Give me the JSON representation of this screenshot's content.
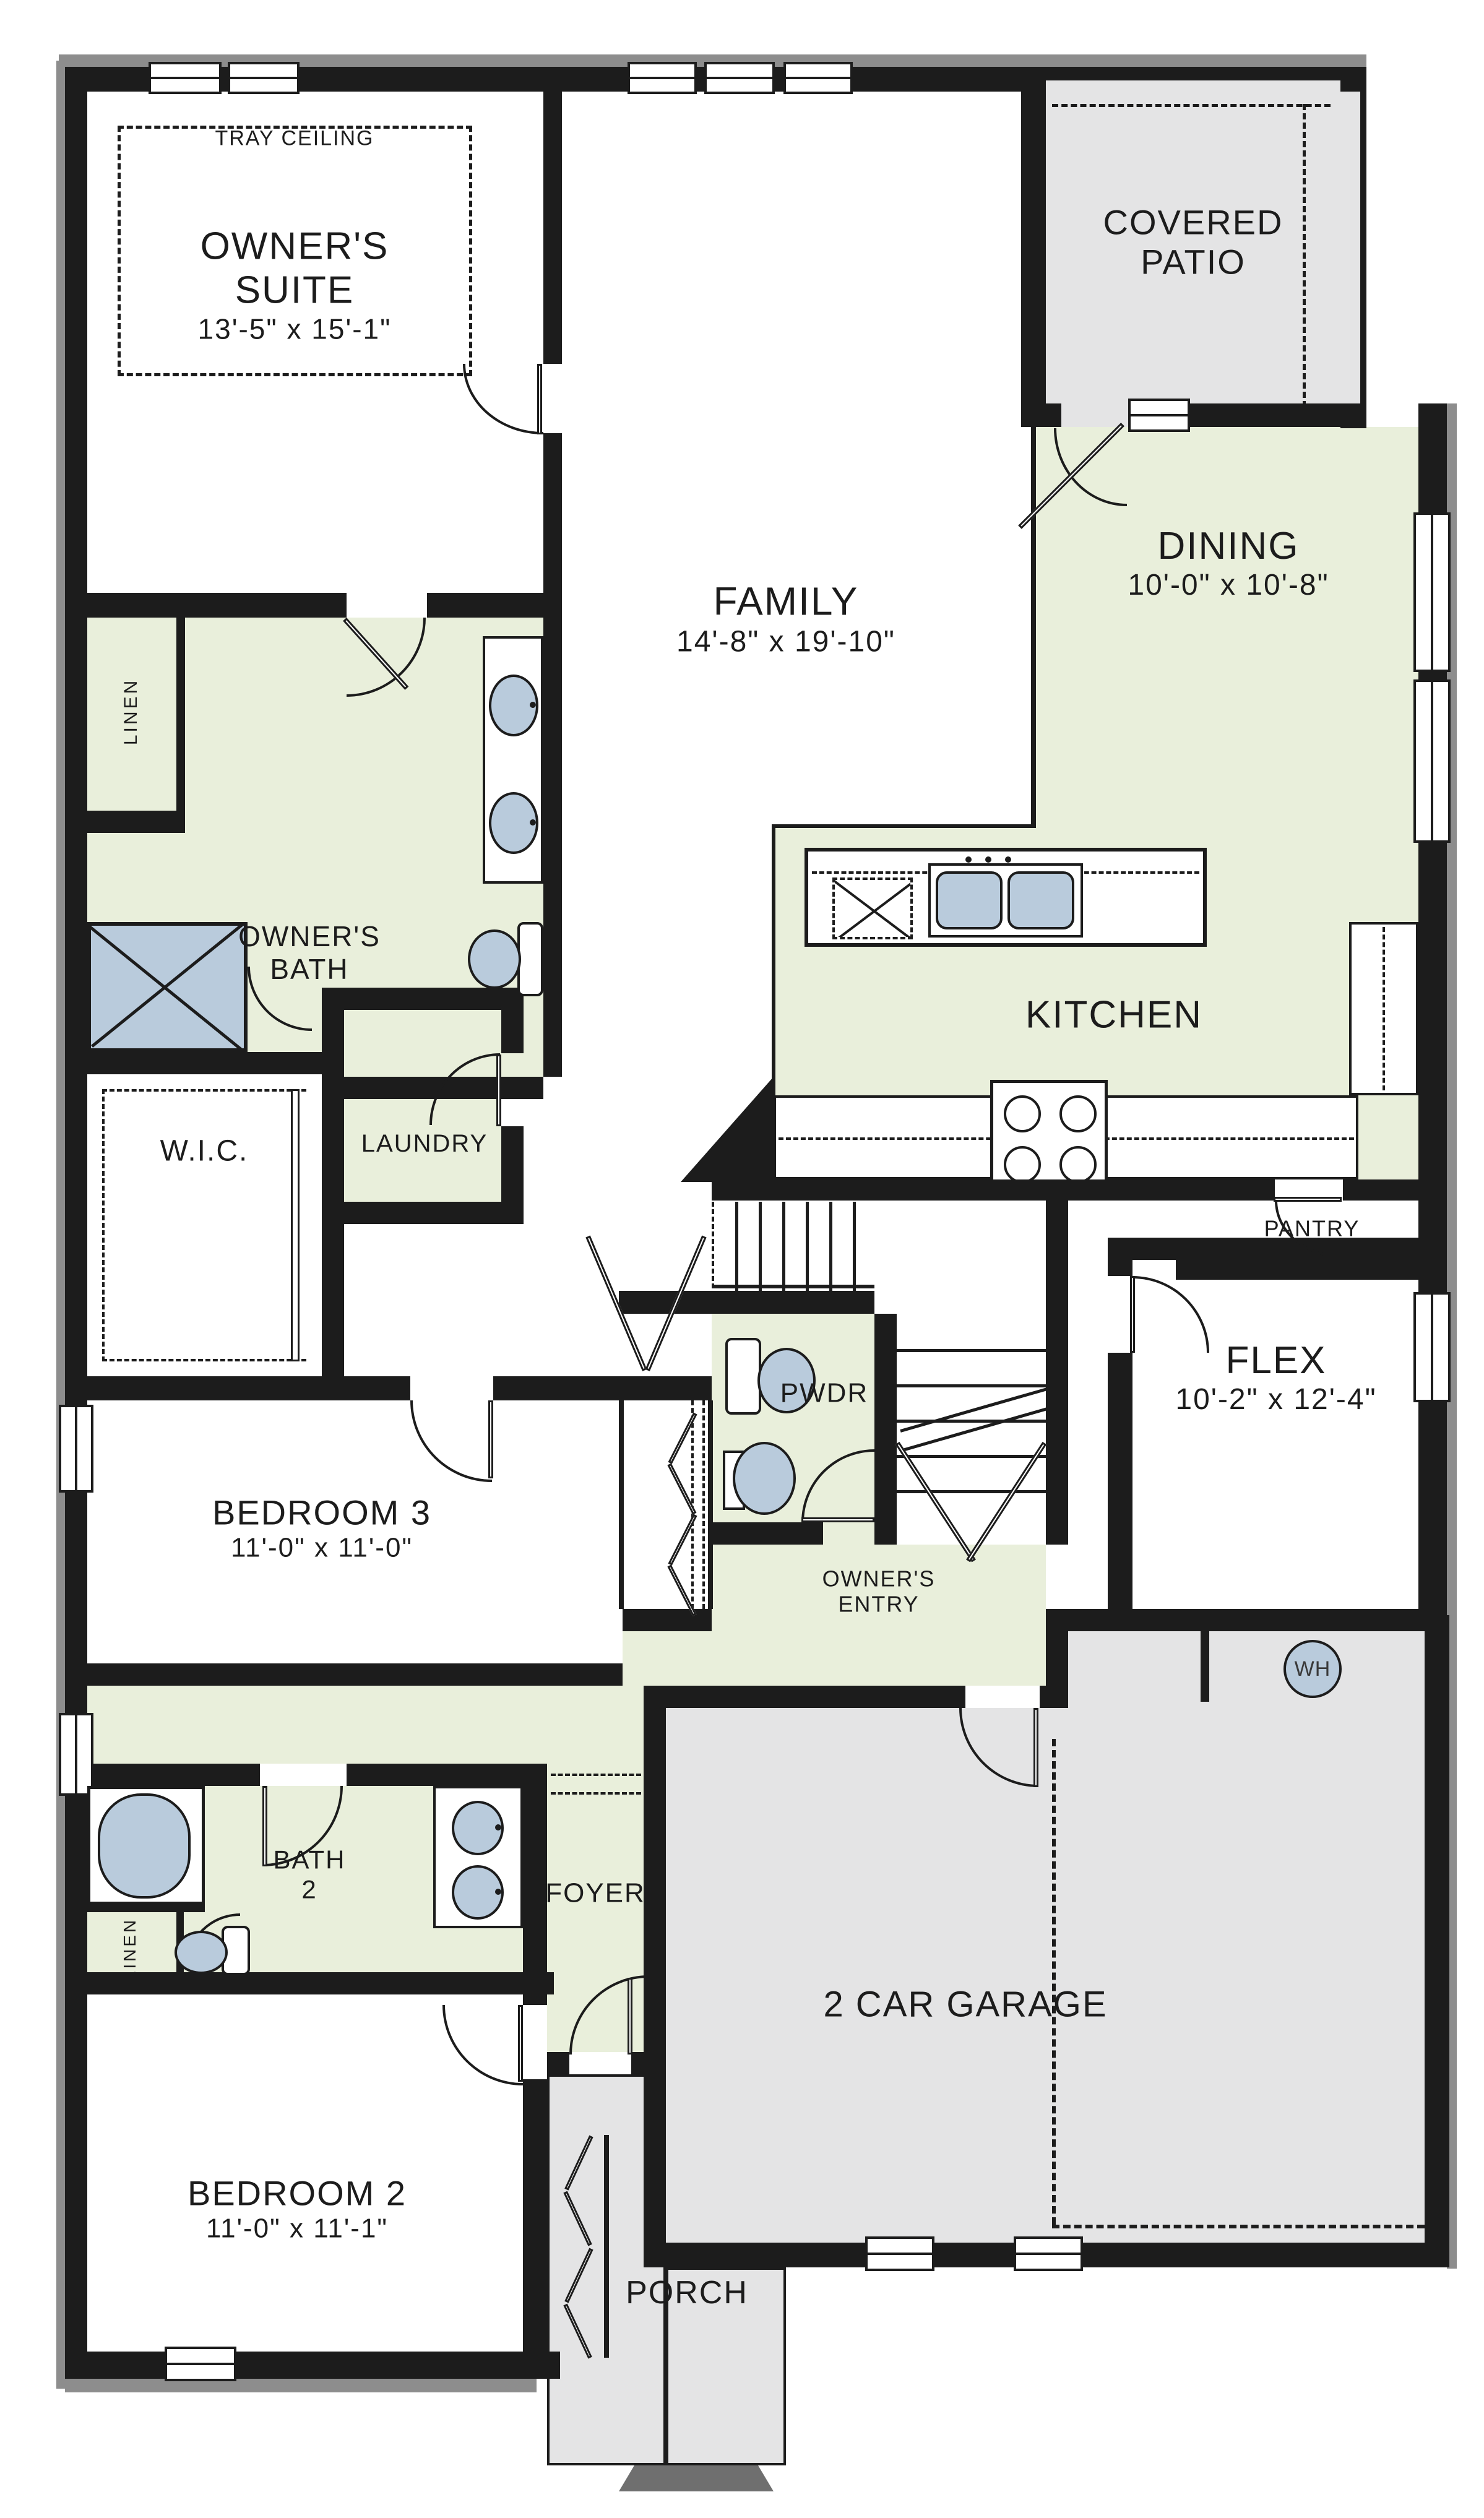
{
  "colors": {
    "wall": "#1c1c1c",
    "interior_green": "#e9efdb",
    "outdoor_gray": "#e4e4e5",
    "fixture_blue": "#b9cbdc",
    "background": "#ffffff"
  },
  "rooms": {
    "owners_suite": {
      "line1": "OWNER'S",
      "line2": "SUITE",
      "dims": "13'-5\" x 15'-1\"",
      "ceiling_note": "TRAY CEILING"
    },
    "family": {
      "name": "FAMILY",
      "dims": "14'-8\" x 19'-10\""
    },
    "covered_patio": {
      "line1": "COVERED",
      "line2": "PATIO"
    },
    "dining": {
      "name": "DINING",
      "dims": "10'-0\" x 10'-8\""
    },
    "kitchen": {
      "name": "KITCHEN"
    },
    "pantry": {
      "name": "PANTRY"
    },
    "owners_bath": {
      "line1": "OWNER'S",
      "line2": "BATH"
    },
    "owners_bath_linen": {
      "name": "LINEN"
    },
    "wic": {
      "name": "W.I.C."
    },
    "laundry": {
      "name": "LAUNDRY"
    },
    "pwdr": {
      "name": "PWDR"
    },
    "flex": {
      "name": "FLEX",
      "dims": "10'-2\" x 12'-4\""
    },
    "bedroom3": {
      "name": "BEDROOM 3",
      "dims": "11'-0\" x 11'-0\""
    },
    "owners_entry": {
      "line1": "OWNER'S",
      "line2": "ENTRY"
    },
    "bath2": {
      "line1": "BATH",
      "line2": "2"
    },
    "bath2_linen": {
      "name": "LINEN"
    },
    "bedroom2": {
      "name": "BEDROOM 2",
      "dims": "11'-0\" x 11'-1\""
    },
    "foyer": {
      "name": "FOYER"
    },
    "garage": {
      "name": "2 CAR GARAGE"
    },
    "porch": {
      "name": "PORCH"
    },
    "water_heater": {
      "label": "WH"
    }
  }
}
